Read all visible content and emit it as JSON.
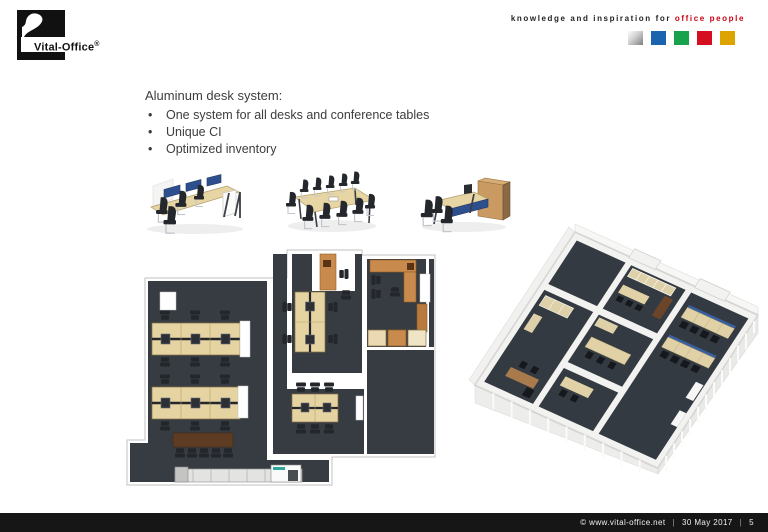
{
  "header": {
    "logo": {
      "brand": "Vital-Office",
      "registered": "®"
    },
    "tagline": {
      "text": "knowledge and inspiration for",
      "highlight": "office people"
    },
    "brand_squares": [
      {
        "name": "silver",
        "color": "silver-gradient"
      },
      {
        "name": "blue",
        "color": "#1a63ae"
      },
      {
        "name": "green",
        "color": "#17a24b"
      },
      {
        "name": "red",
        "color": "#d40f1f"
      },
      {
        "name": "gold",
        "color": "#dda400"
      }
    ]
  },
  "content": {
    "heading": "Aluminum desk system:",
    "bullets": [
      "One system for all desks and conference tables",
      "Unique CI",
      "Optimized inventory"
    ]
  },
  "figures": {
    "product_images": [
      {
        "name": "bench-desk-system-render"
      },
      {
        "name": "conference-table-render"
      },
      {
        "name": "desk-with-cabinet-render"
      }
    ],
    "floor_plan_2d": {
      "name": "office-floor-plan-top-view"
    },
    "floor_plan_3d": {
      "name": "office-floor-plan-3d-render"
    }
  },
  "footer": {
    "copyright": "© www.vital-office.net",
    "separator": "|",
    "date": "30 May 2017",
    "page": "5"
  },
  "colors": {
    "accent_red": "#cc0010",
    "footer_bar": "#161616",
    "plan_floor": "#373c42",
    "desk_beige": "#e6d3a2",
    "furniture_orange": "#c98a4d",
    "table_brown": "#5e3c24",
    "screen_blue": "#2e4f8e"
  }
}
